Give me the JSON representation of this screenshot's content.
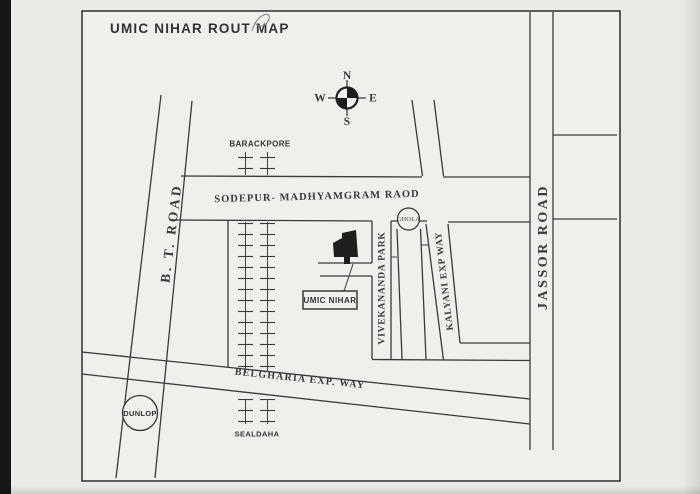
{
  "document": {
    "title": "UMIC NIHAR ROUT MAP"
  },
  "compass": {
    "n": "N",
    "s": "S",
    "e": "E",
    "w": "W"
  },
  "roads": {
    "bt": {
      "label": "B. T. ROAD"
    },
    "jassor": {
      "label": "JASSOR ROAD"
    },
    "sodepur": {
      "label": "SODEPUR- MADHYAMGRAM RAOD"
    },
    "vivekananda": {
      "label": "VIVEKANANDA PARK"
    },
    "kalyani": {
      "label": "KALYANI EXP WAY"
    },
    "belgharia": {
      "label": "BELGHARIA EXP. WAY"
    }
  },
  "landmarks": {
    "barackpore": {
      "label": "BARACKPORE"
    },
    "sealdaha": {
      "label": "SEALDAHA"
    },
    "ghola": {
      "label": "GHOLA"
    },
    "dunlop": {
      "label": "DUNLOP"
    },
    "umic_nihar": {
      "label": "UMIC NIHAR"
    }
  },
  "colors": {
    "ink": "#3a3a3a",
    "paper": "#ebeae6",
    "building": "#1f1f1f",
    "scan_edge": "#161616"
  }
}
